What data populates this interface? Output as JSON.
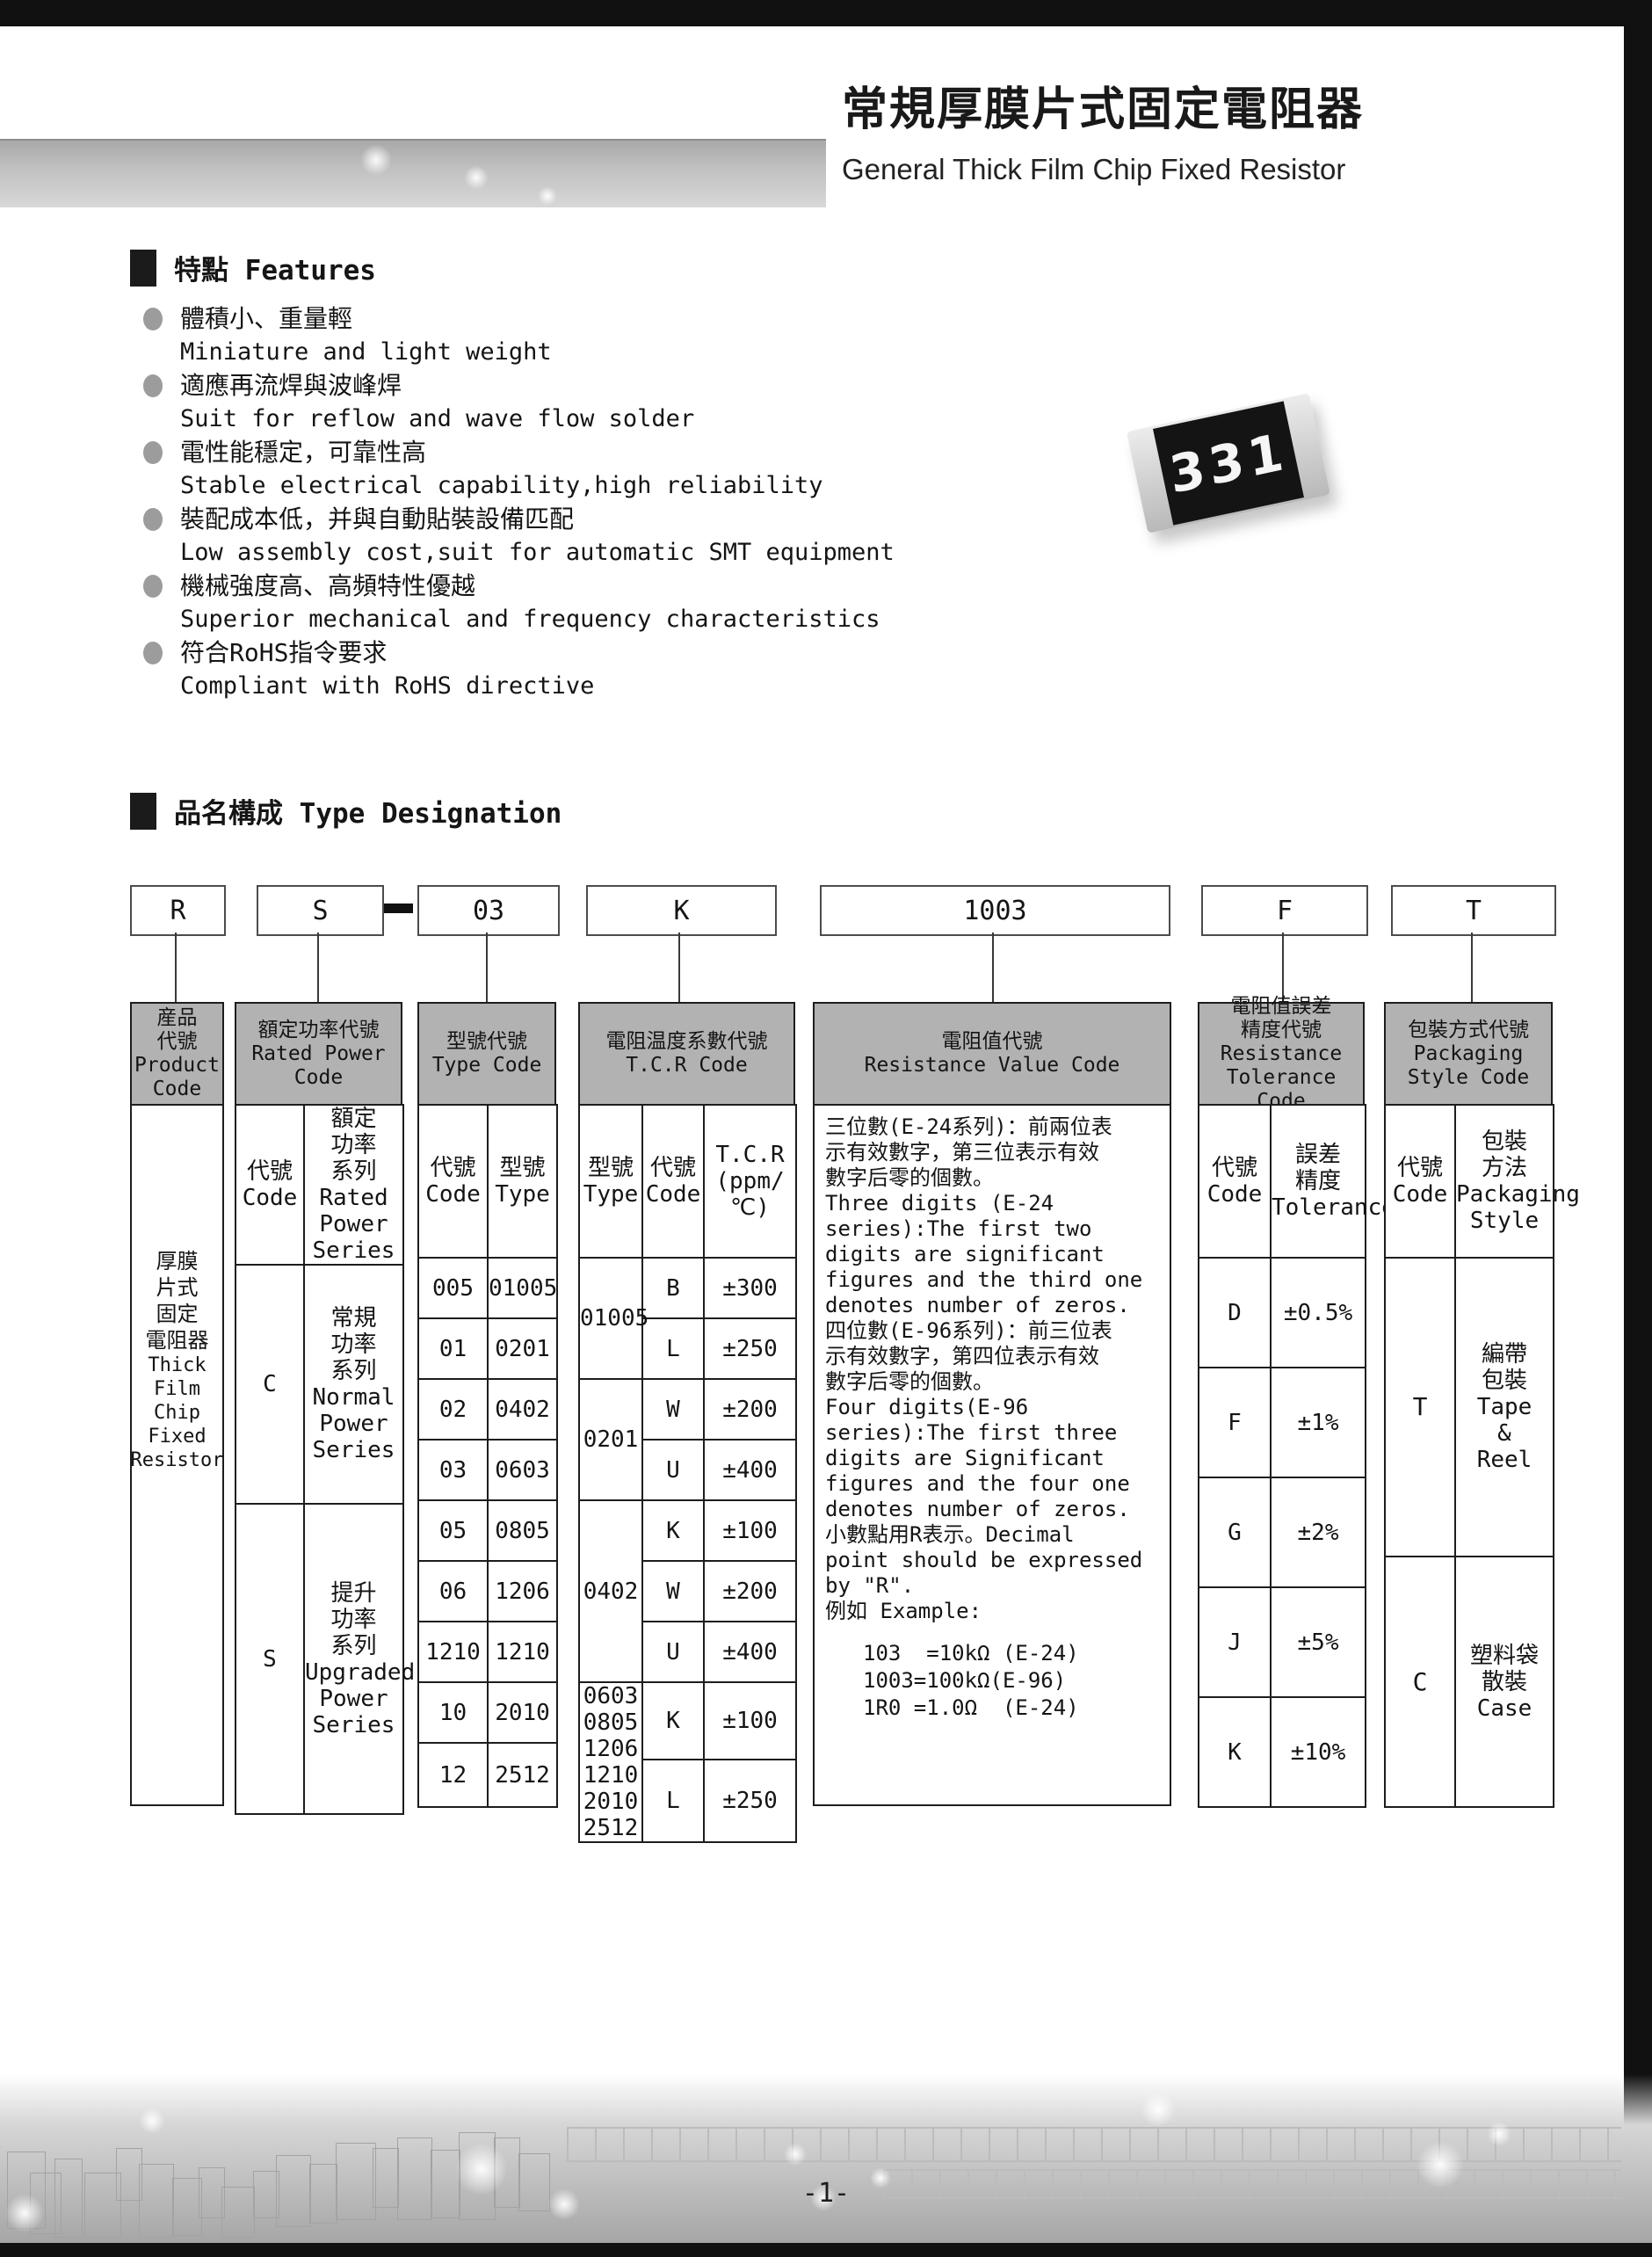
{
  "header": {
    "title_zh": "常規厚膜片式固定電阻器",
    "title_en": "General Thick Film Chip Fixed Resistor"
  },
  "features": {
    "heading": "特點 Features",
    "items": [
      {
        "zh": "體積小、重量輕",
        "en": "Miniature and light weight"
      },
      {
        "zh": "適應再流焊與波峰焊",
        "en": "Suit for reflow and wave flow solder"
      },
      {
        "zh": "電性能穩定，可靠性高",
        "en": "Stable electrical capability,high reliability"
      },
      {
        "zh": "裝配成本低，并與自動貼裝設備匹配",
        "en": "Low assembly cost,suit for automatic SMT equipment"
      },
      {
        "zh": "機械強度高、高頻特性優越",
        "en": "Superior mechanical and frequency characteristics"
      },
      {
        "zh": "符合RoHS指令要求",
        "en": "Compliant with RoHS directive"
      }
    ]
  },
  "resistor": {
    "label": "331"
  },
  "designation": {
    "heading": "品名構成  Type Designation",
    "codes": {
      "product": "R",
      "power": "S",
      "type": "03",
      "tcr": "K",
      "value": "1003",
      "tolerance": "F",
      "packaging": "T"
    },
    "product": {
      "header": "産品\n代號\nProduct\nCode",
      "body_zh": "厚膜\n片式\n固定\n電阻器",
      "body_en": "Thick\nFilm\nChip\nFixed\nResistor"
    },
    "power": {
      "header": "額定功率代號\nRated Power\nCode",
      "sub_code": "代號\nCode",
      "sub_series": "額定\n功率\n系列\nRated\nPower\nSeries",
      "rows": [
        {
          "code": "C",
          "series": "常規\n功率\n系列\nNormal\nPower\nSeries"
        },
        {
          "code": "S",
          "series": "提升\n功率\n系列\nUpgraded\nPower\nSeries"
        }
      ]
    },
    "type": {
      "header": "型號代號\nType Code",
      "sub_code": "代號\nCode",
      "sub_type": "型號\nType",
      "rows": [
        [
          "005",
          "01005"
        ],
        [
          "01",
          "0201"
        ],
        [
          "02",
          "0402"
        ],
        [
          "03",
          "0603"
        ],
        [
          "05",
          "0805"
        ],
        [
          "06",
          "1206"
        ],
        [
          "1210",
          "1210"
        ],
        [
          "10",
          "2010"
        ],
        [
          "12",
          "2512"
        ]
      ]
    },
    "tcr": {
      "header": "電阻温度系數代號\nT.C.R Code",
      "sub_type": "型號\nType",
      "sub_code": "代號\nCode",
      "sub_tcr": "T.C.R\n(ppm/℃)",
      "types": [
        "01005",
        "0201",
        "0402",
        "0603\n0805\n1206\n1210\n2010\n2512"
      ],
      "rows": [
        [
          "B",
          "±300"
        ],
        [
          "L",
          "±250"
        ],
        [
          "W",
          "±200"
        ],
        [
          "U",
          "±400"
        ],
        [
          "K",
          "±100"
        ],
        [
          "W",
          "±200"
        ],
        [
          "U",
          "±400"
        ],
        [
          "K",
          "±100"
        ],
        [
          "L",
          "±250"
        ]
      ]
    },
    "value": {
      "header": "電阻值代號\nResistance Value Code",
      "text": "三位數(E-24系列)：前兩位表\n示有效數字，第三位表示有效\n數字后零的個數。\nThree digits (E-24\nseries):The first two\ndigits are significant\nfigures and the third one\ndenotes number of zeros.\n四位數(E-96系列)：前三位表\n示有效數字，第四位表示有效\n數字后零的個數。\nFour digits(E-96\nseries):The first three\ndigits are Significant\nfigures and the four one\ndenotes number of zeros.\n小數點用R表示。Decimal\npoint should be expressed\nby \"R\".\n例如 Example:",
      "examples": "103  =10kΩ (E-24)\n1003=100kΩ(E-96)\n1R0 =1.0Ω  (E-24)"
    },
    "tolerance": {
      "header": "電阻值誤差\n精度代號\nResistance\nTolerance Code",
      "sub_code": "代號\nCode",
      "sub_tol": "誤差\n精度\nTolerance",
      "rows": [
        [
          "D",
          "±0.5%"
        ],
        [
          "F",
          "±1%"
        ],
        [
          "G",
          "±2%"
        ],
        [
          "J",
          "±5%"
        ],
        [
          "K",
          "±10%"
        ]
      ]
    },
    "packaging": {
      "header": "包裝方式代號\nPackaging\nStyle Code",
      "sub_code": "代號\nCode",
      "sub_style": "包裝\n方法\nPackaging\nStyle",
      "rows": [
        {
          "code": "T",
          "style": "編帶\n包裝\nTape\n&\nReel"
        },
        {
          "code": "C",
          "style": "塑料袋\n散裝\nCase"
        }
      ]
    }
  },
  "footer": {
    "page_number": "-1-"
  }
}
